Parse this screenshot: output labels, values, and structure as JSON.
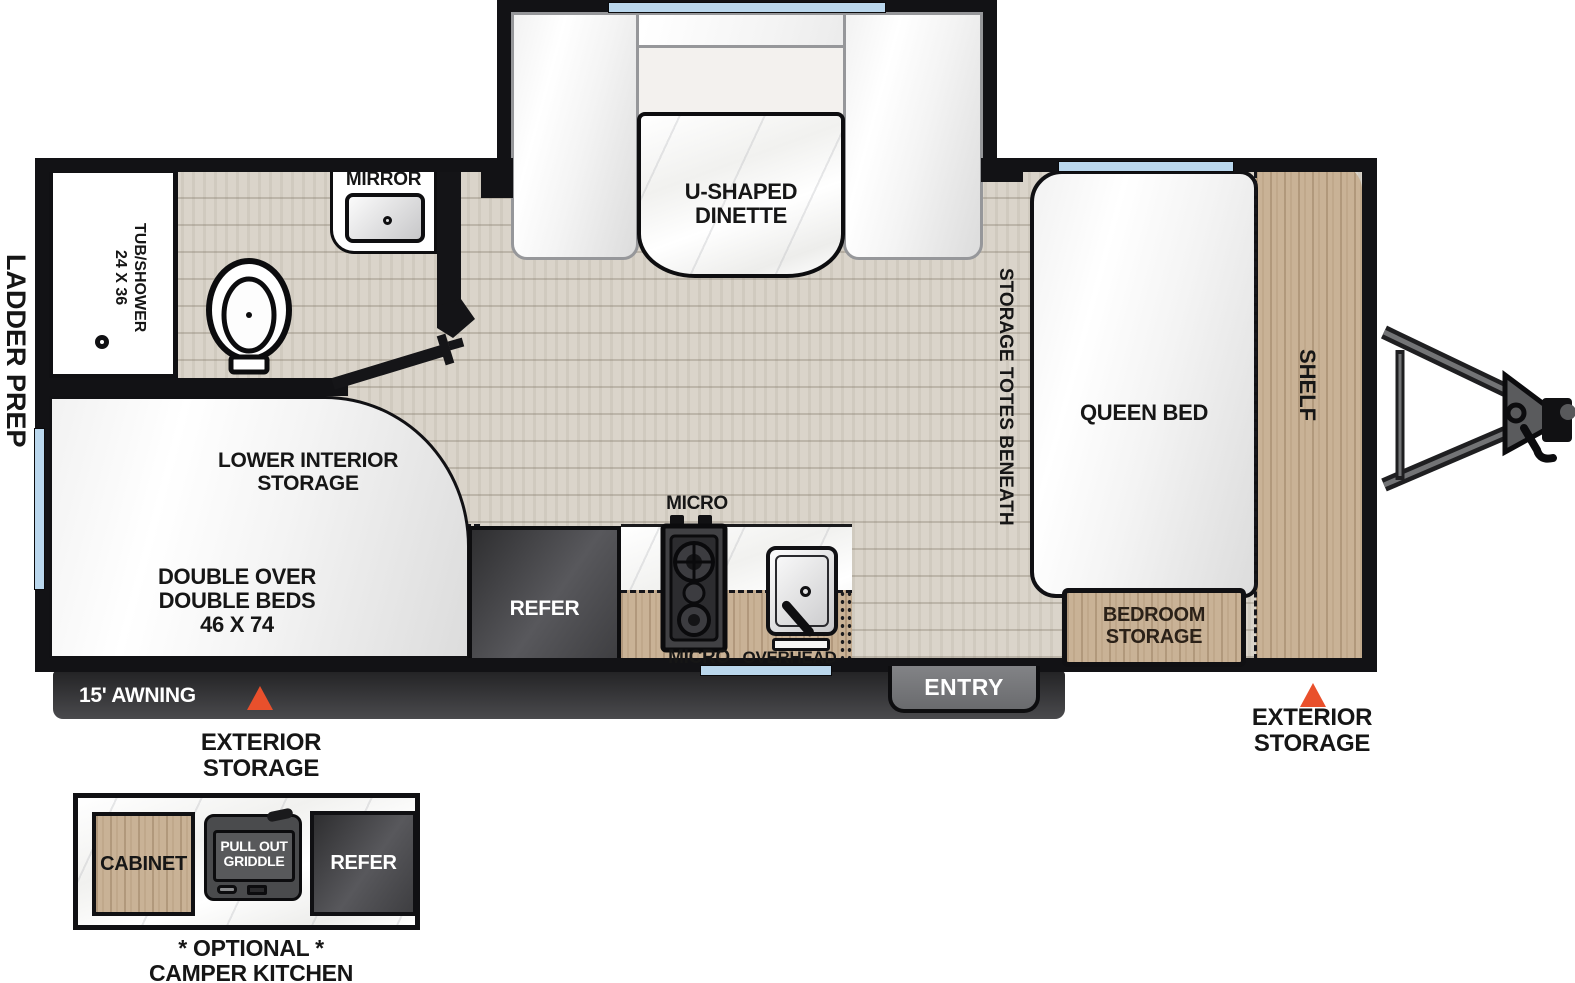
{
  "title": "Travel trailer floorplan diagram",
  "colors": {
    "wall_black": "#121215",
    "accent_orange": "#e9502c",
    "window_blue": "#bad7ed",
    "wood_tan": "#c9b296",
    "floor_wood": "#dad4ca",
    "appliance_dark": "#48484c",
    "awning_bar": "#2c2c2e"
  },
  "labels": {
    "ladder_prep": "LADDER PREP",
    "tub_line1": "24 X 36",
    "tub_line2": "TUB/SHOWER",
    "mirror": "MIRROR",
    "dinette_line1": "U-SHAPED",
    "dinette_line2": "DINETTE",
    "storage_totes": "STORAGE TOTES BENEATH",
    "queen_bed": "QUEEN BED",
    "shelf": "SHELF",
    "bedroom_storage_line1": "BEDROOM",
    "bedroom_storage_line2": "STORAGE",
    "lower_storage_line1": "LOWER INTERIOR",
    "lower_storage_line2": "STORAGE",
    "double_bed_line1": "DOUBLE OVER",
    "double_bed_line2": "DOUBLE BEDS",
    "double_bed_line3": "46 X 74",
    "refer": "REFER",
    "micro_top": "MICRO",
    "micro_bottom": "MICRO",
    "overhead": "OVERHEAD",
    "entry": "ENTRY",
    "awning": "15' AWNING",
    "exterior_storage_line1": "EXTERIOR",
    "exterior_storage_line2": "STORAGE"
  },
  "camper_kitchen": {
    "cabinet": "CABINET",
    "griddle_line1": "PULL OUT",
    "griddle_line2": "GRIDDLE",
    "refer": "REFER",
    "caption_line1": "* OPTIONAL *",
    "caption_line2": "CAMPER KITCHEN"
  }
}
